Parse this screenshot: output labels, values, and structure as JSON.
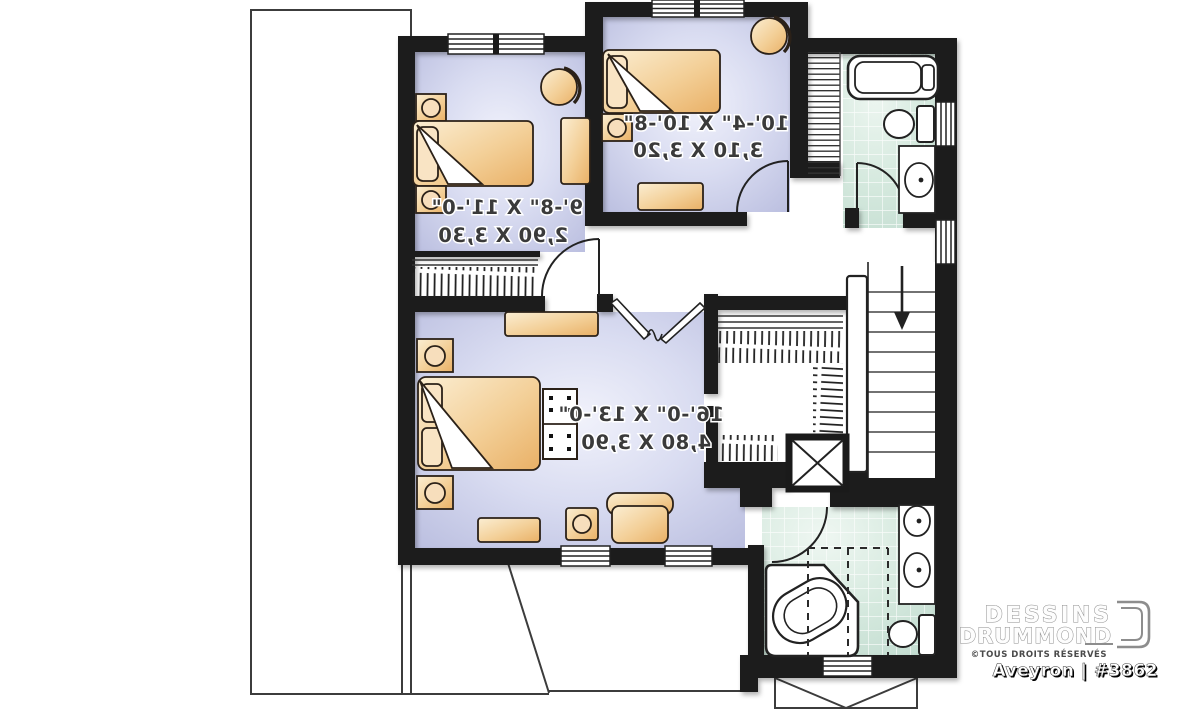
{
  "plan": {
    "brand": {
      "line1": "DESSINS",
      "line2": "DRUMMOND",
      "rights": "©TOUS DROITS RÉSERVÉS",
      "plan_id": "Aveyron | #3862"
    },
    "rooms": {
      "bedroom1": {
        "imperial": "9'-8\" X 11'-0\"",
        "metric": "2,90 X 3,30"
      },
      "bedroom2": {
        "imperial": "10'-4\" X 10'-8\"",
        "metric": "3,10 X 3,20"
      },
      "master": {
        "imperial": "16'-0\" X 13'-0\"",
        "metric": "4,80 X 3,90"
      }
    },
    "colors": {
      "wall": "#1a1a1a",
      "bedroom_floor": "#d2d5ee",
      "bath_floor": "#d5e9de",
      "furniture": "#f3cf97",
      "dimension_text": "#3a3a3a",
      "roof_line": "#3c3c3c"
    }
  }
}
